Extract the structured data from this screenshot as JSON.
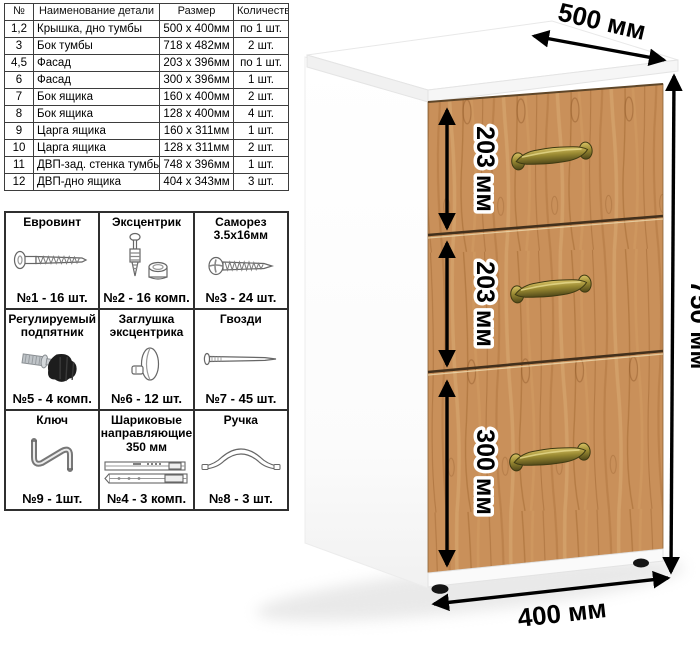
{
  "parts_table": {
    "headers": [
      "№",
      "Наименование детали",
      "Размер",
      "Количество"
    ],
    "rows": [
      [
        "1,2",
        "Крышка, дно тумбы",
        "500 x 400мм",
        "по 1 шт."
      ],
      [
        "3",
        "Бок тумбы",
        "718 x 482мм",
        "2 шт."
      ],
      [
        "4,5",
        "Фасад",
        "203 x 396мм",
        "по 1 шт."
      ],
      [
        "6",
        "Фасад",
        "300 x 396мм",
        "1 шт."
      ],
      [
        "7",
        "Бок ящика",
        "160 x 400мм",
        "2 шт."
      ],
      [
        "8",
        "Бок ящика",
        "128 x 400мм",
        "4 шт."
      ],
      [
        "9",
        "Царга ящика",
        "160 x 311мм",
        "1 шт."
      ],
      [
        "10",
        "Царга ящика",
        "128 x 311мм",
        "2 шт."
      ],
      [
        "11",
        "ДВП-зад. стенка тумбы",
        "748 x 396мм",
        "1 шт."
      ],
      [
        "12",
        "ДВП-дно ящика",
        "404 x 343мм",
        "3 шт."
      ]
    ]
  },
  "hardware": {
    "items": [
      {
        "name": "Евровинт",
        "count": "№1 - 16 шт.",
        "icon": "eurovint-icon"
      },
      {
        "name": "Эксцентрик",
        "count": "№2 - 16 комп.",
        "icon": "eccentric-cam-icon"
      },
      {
        "name": "Саморез 3.5х16мм",
        "count": "№3 - 24 шт.",
        "icon": "self-tapping-screw-icon"
      },
      {
        "name": "Регулируемый подпятник",
        "count": "№5 - 4 комп.",
        "icon": "adjustable-foot-icon"
      },
      {
        "name": "Заглушка эксцентрика",
        "count": "№6 - 12 шт.",
        "icon": "cam-cap-icon"
      },
      {
        "name": "Гвозди",
        "count": "№7 - 45 шт.",
        "icon": "nail-icon"
      },
      {
        "name": "Ключ",
        "count": "№9 - 1шт.",
        "icon": "hex-key-icon"
      },
      {
        "name": "Шариковые направляющие 350 мм",
        "count": "№4 - 3 комп.",
        "icon": "ball-bearing-slides-icon"
      },
      {
        "name": "Ручка",
        "count": "№8 - 3 шт.",
        "icon": "handle-icon"
      }
    ]
  },
  "cabinet": {
    "dim_width_top": "500 мм",
    "dim_height_right": "750 мм",
    "dim_depth_bottom": "400 мм",
    "drawer_dims": [
      "203 мм",
      "203 мм",
      "300 мм"
    ],
    "colors": {
      "wood": "#c9905a",
      "handle_brass": "#9b8b33",
      "dimension_lines": "#000000",
      "body": "#ffffff"
    }
  }
}
